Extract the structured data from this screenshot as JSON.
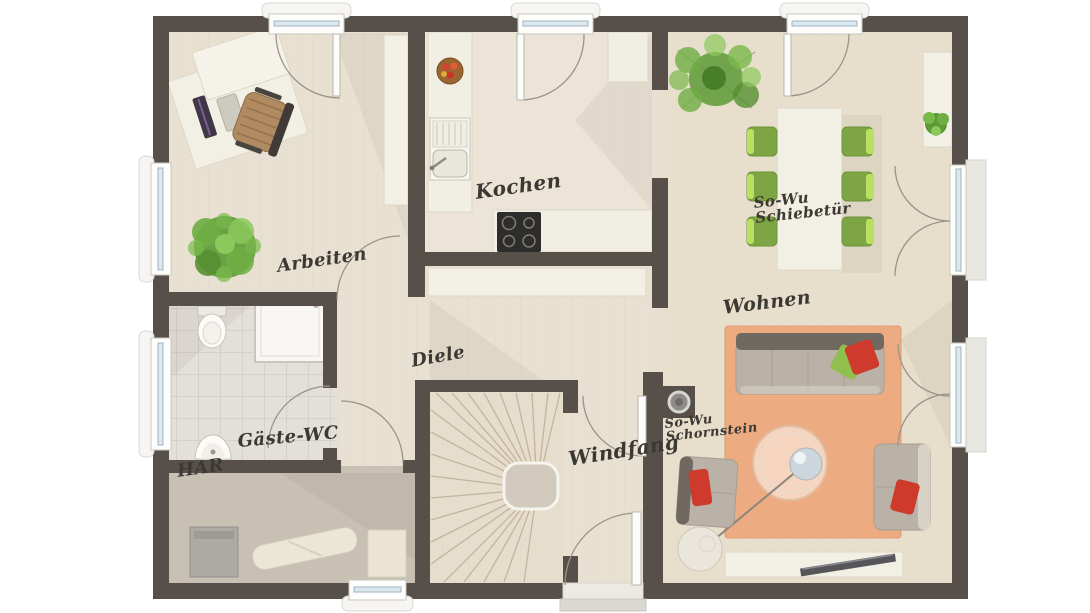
{
  "title": "Ground floor plan",
  "rooms": {
    "arbeiten": {
      "label": "Arbeiten"
    },
    "kochen": {
      "label": "Kochen"
    },
    "wohnen": {
      "label": "Wohnen"
    },
    "diele": {
      "label": "Diele"
    },
    "windfang": {
      "label": "Windfang"
    },
    "gaeste_wc": {
      "label": "Gäste-WC"
    },
    "har": {
      "label": "HAR"
    }
  },
  "annotations": {
    "schiebetuer": {
      "line1": "So-Wu",
      "line2": "Schiebetür"
    },
    "schornstein": {
      "line1": "So-Wu",
      "line2": "Schornstein"
    }
  },
  "furniture": [
    "desk",
    "office-chair",
    "wardrobe",
    "potted-plant",
    "kitchen-counter",
    "kitchen-sink",
    "stove",
    "fridge-cabinet",
    "fruit-bowl",
    "hall-sideboard",
    "dining-table",
    "dining-chairs-green",
    "large-plant",
    "sideboard",
    "sofa",
    "coffee-table",
    "armchair",
    "side-table",
    "tv-lowboard",
    "rug",
    "toilet",
    "shower",
    "washbasin",
    "washing-machine",
    "ironing-board",
    "storage-box",
    "winder-staircase",
    "chimney"
  ],
  "colors": {
    "bg": "#ffffff",
    "wall": "#57504a",
    "floor-wood": "#e8e0d1",
    "floor-living": "#e7dcc6",
    "floor-wc": "#e3e0da",
    "floor-har": "#c8c0b3",
    "rug": "#ecab81",
    "counter": "#f1eee3",
    "chair-green": "#7da544",
    "chair-lime": "#b9e05e",
    "sofa": "#bbb2a7",
    "sofa-back": "#6f6961",
    "pillow-red": "#ce3a2b",
    "pillow-green": "#90bf4e",
    "plant-green": "#5d9a36",
    "glass": "#dce8ef",
    "stair-step": "#bcae97",
    "label": "#3c3833"
  }
}
